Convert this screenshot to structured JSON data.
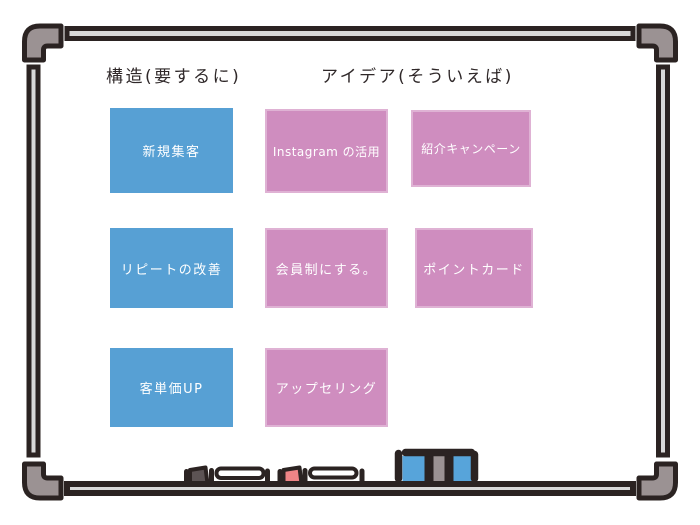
{
  "headings": {
    "structure": "構造(要するに)",
    "ideas": "アイデア(そういえば)"
  },
  "notes": [
    {
      "label": "新規集客",
      "color": "blue",
      "column": "structure"
    },
    {
      "label": "Instagram の活用",
      "color": "pink",
      "column": "ideas"
    },
    {
      "label": "紹介キャンペーン",
      "color": "pink",
      "column": "ideas"
    },
    {
      "label": "リピートの改善",
      "color": "blue",
      "column": "structure"
    },
    {
      "label": "会員制にする。",
      "color": "pink",
      "column": "ideas"
    },
    {
      "label": "ポイントカード",
      "color": "pink",
      "column": "ideas"
    },
    {
      "label": "客単価UP",
      "color": "blue",
      "column": "structure"
    },
    {
      "label": "アップセリング",
      "color": "pink",
      "column": "ideas"
    }
  ],
  "tray": {
    "items": [
      {
        "icon": "marker-dark-icon"
      },
      {
        "icon": "marker-red-icon"
      },
      {
        "icon": "eraser-icon"
      }
    ]
  },
  "colors": {
    "heading_text": "#2f2829",
    "note_blue": "#57a0d4",
    "note_pink": "#cf8dbf",
    "note_pink_border": "#dfb2d4",
    "note_text": "#ffffff",
    "frame_ink": "#2b2322",
    "frame_corner": "#9b9293",
    "frame_rail": "#d9d9d9",
    "marker_cap_dark": "#5c5354",
    "marker_cap_red": "#ee8486",
    "marker_body": "#ffffff",
    "eraser_blue": "#57a4da",
    "eraser_gray": "#9b9293"
  }
}
